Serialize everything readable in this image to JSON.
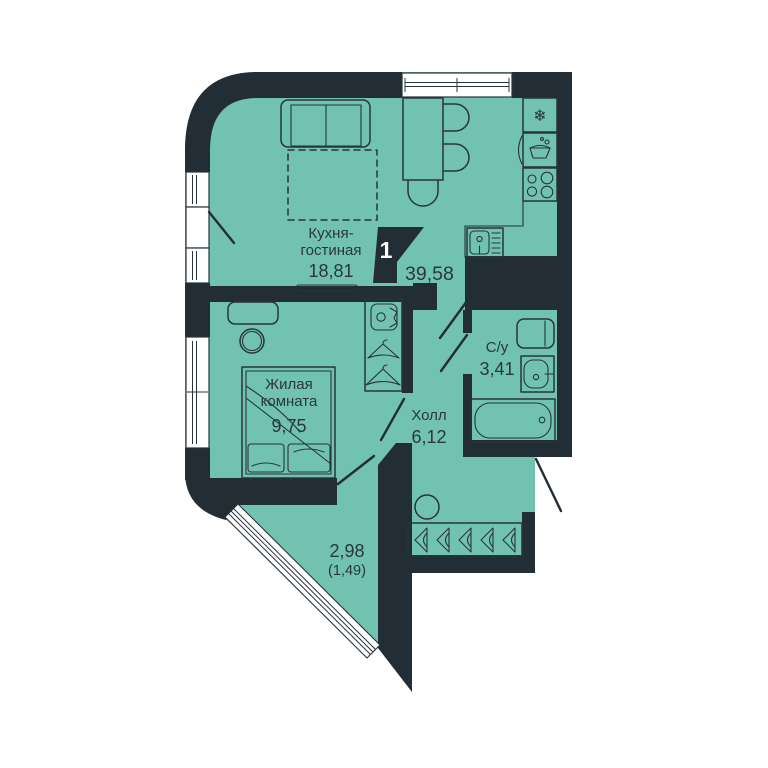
{
  "plan": {
    "unit_badge": {
      "number": "1",
      "total_area": "39,58"
    },
    "rooms": {
      "kitchen_living": {
        "name_line1": "Кухня-",
        "name_line2": "гостиная",
        "area": "18,81"
      },
      "bedroom": {
        "name_line1": "Жилая",
        "name_line2": "комната",
        "area": "9,75"
      },
      "hall": {
        "name": "Холл",
        "area": "6,12"
      },
      "bathroom": {
        "name": "С/у",
        "area": "3,41"
      },
      "balcony": {
        "area": "2,98",
        "area_reduced": "(1,49)"
      }
    },
    "icons": {
      "fridge_snowflake": "❄"
    },
    "colors": {
      "floor": "#71c2b0",
      "wall": "#222d35",
      "furniture_line": "#28343c",
      "text": "#2b363e",
      "background": "#ffffff",
      "window": "#ffffff",
      "badge_text": "#ffffff"
    }
  }
}
